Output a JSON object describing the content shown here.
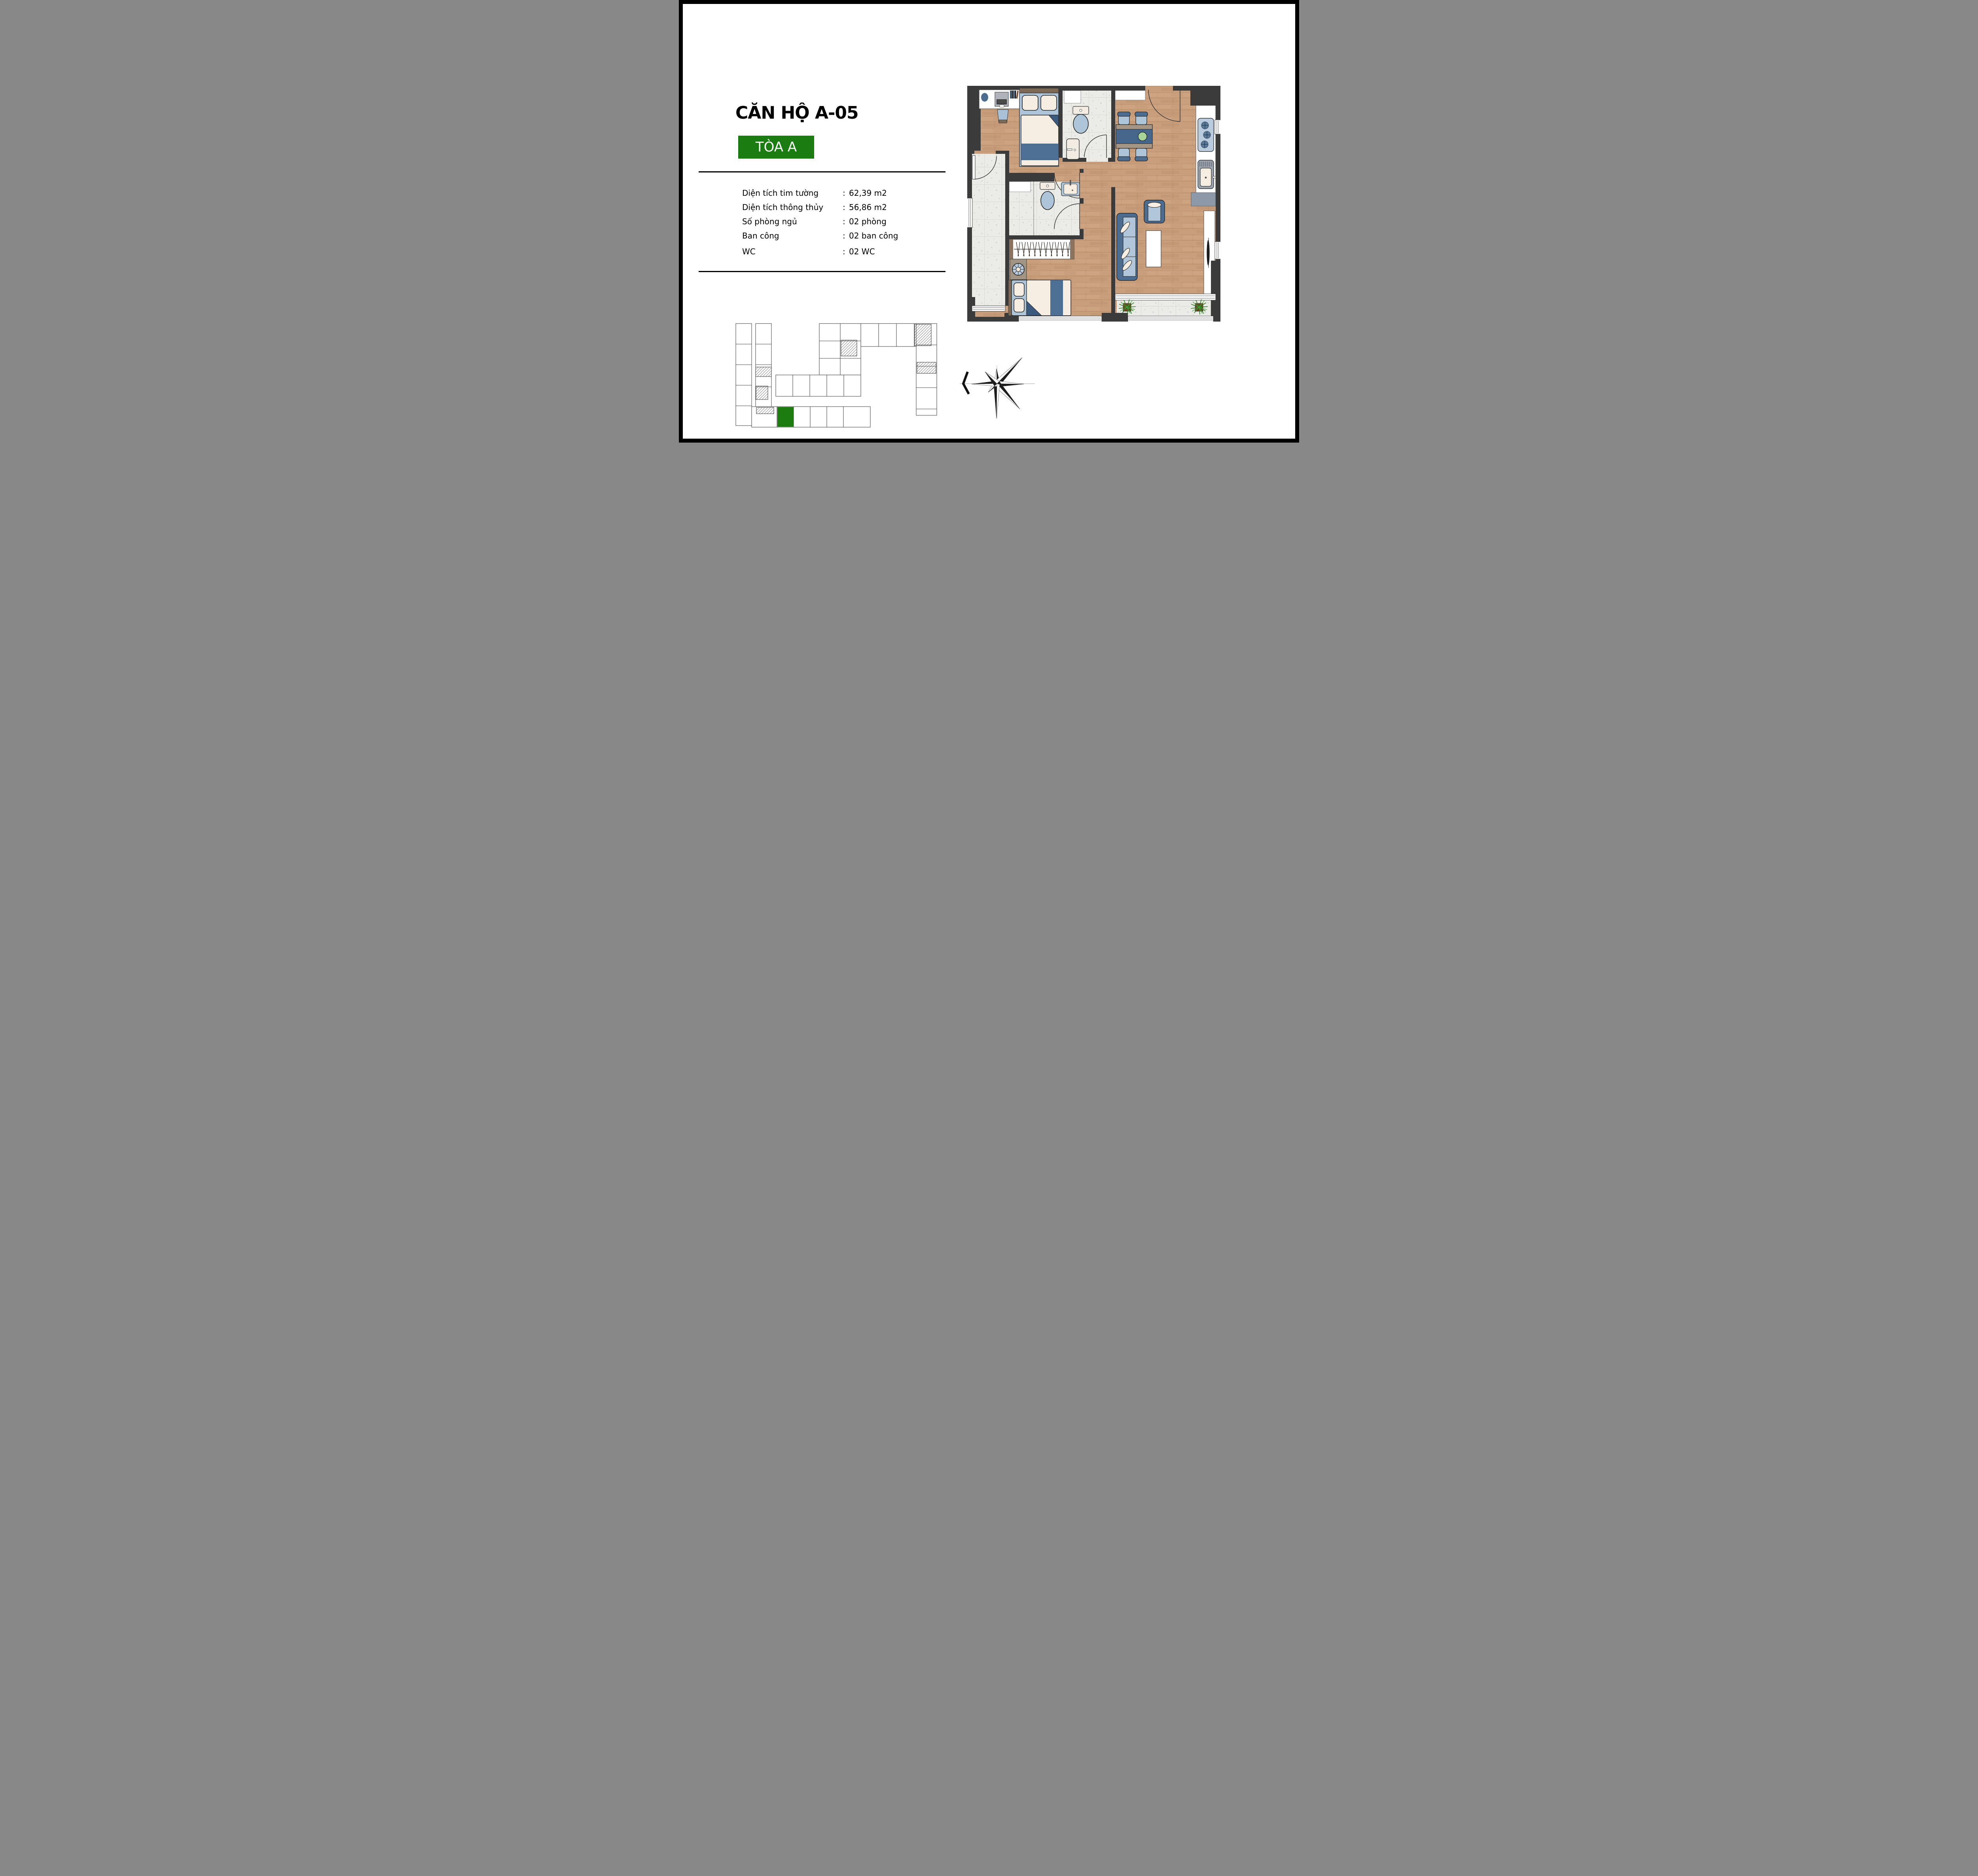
{
  "page": {
    "background": "#ffffff",
    "frame_color": "#000000"
  },
  "header": {
    "title": "CĂN HỘ A-05",
    "badge": {
      "label": "TÒA A",
      "background": "#1a7c11",
      "text_color": "#ffffff"
    }
  },
  "specs": {
    "rows": [
      {
        "label": "Diện tích tim tường",
        "separator": ":",
        "value": "62,39 m2"
      },
      {
        "label": "Diện tích thông thủy",
        "separator": ":",
        "value": "56,86 m2"
      },
      {
        "label": "Số phòng ngủ",
        "separator": ":",
        "value": "02 phòng"
      },
      {
        "label": "Ban công",
        "separator": ":",
        "value": "02 ban công"
      },
      {
        "label": "WC",
        "separator": ":",
        "value": "02 WC"
      }
    ]
  },
  "floor_plan": {
    "colors": {
      "wall": "#3b3b3b",
      "wood_floor": "#c89e7c",
      "tile_floor": "#ebebe8",
      "furniture_blue_dark": "#4c6c90",
      "furniture_blue_light": "#aec4d8",
      "cream": "#f6eee3",
      "wood_trim": "#8a7460",
      "plant_green": "#2e7d22",
      "plate_green": "#a8d49a",
      "cabinet_gray": "#8d98a8"
    },
    "icons": [
      "double-bed-icon",
      "single-bed-icon",
      "desk-laptop-icon",
      "stool-icon",
      "toilet-icon",
      "wash-basin-icon",
      "wardrobe-hangers-icon",
      "fan-icon",
      "dining-table-icon",
      "chair-icon",
      "gas-stove-icon",
      "kitchen-sink-icon",
      "sofa-icon",
      "armchair-icon",
      "coffee-table-icon",
      "tv-console-icon",
      "potted-plant-icon",
      "door-swing-icon",
      "window-icon",
      "balcony-tile-icon"
    ]
  },
  "key_plan": {
    "icon": "building-key-plan",
    "highlight_color": "#1d7c10",
    "highlighted_unit": "A-05"
  },
  "compass": {
    "icon": "compass-star-icon",
    "pointer": "chevron-west"
  }
}
